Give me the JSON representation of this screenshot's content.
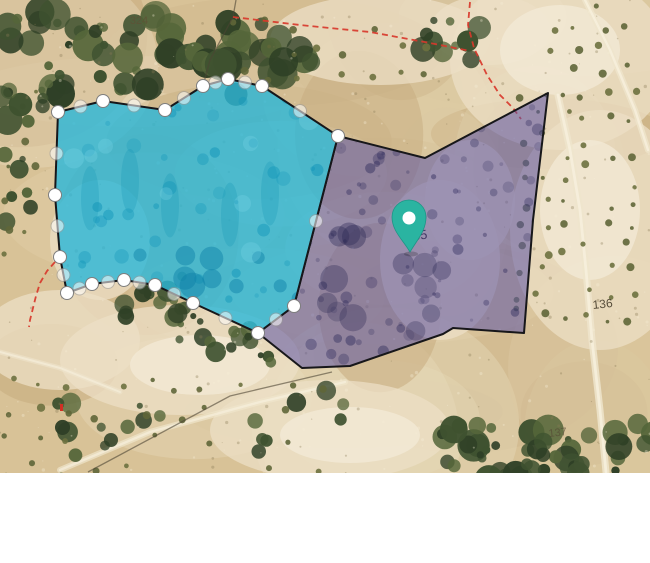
{
  "map": {
    "view": {
      "width": 650,
      "map_height": 473,
      "total_height": 563,
      "area_below_map_color": "#ffffff"
    },
    "terrain_palette": {
      "land_base": "#d8c297",
      "land_soft": [
        "#e3d4b0",
        "#cfb88e",
        "#e9ddbf",
        "#c8ad80",
        "#dcc9a2"
      ],
      "field_pale": "#ecdfc6",
      "field_paler": "#f3ebd9",
      "scrub_dark": "#3f5230",
      "scrub_mid": "#55663a",
      "scrub_deep": "#2f4026",
      "olive_dot_a": "#5f6638",
      "olive_dot_b": "#6d713f",
      "path_light": "#efe5cc",
      "path_bright": "#f7f0dd",
      "track_dark": "#4c4434",
      "speckle_dark": "#8a7a55",
      "speckle_light": "#f5edd8"
    },
    "parcel_labels": [
      {
        "text": "324",
        "x": 139,
        "y": 24,
        "color": "#5f5136",
        "size": 11,
        "opacity": 0.8,
        "rotation": 0
      },
      {
        "text": "135",
        "x": 417,
        "y": 240,
        "color": "#3e3560",
        "size": 13,
        "opacity": 0.95,
        "rotation": -8
      },
      {
        "text": "136",
        "x": 603,
        "y": 308,
        "color": "#463d2c",
        "size": 12,
        "opacity": 0.9,
        "rotation": -6
      },
      {
        "text": "137",
        "x": 558,
        "y": 436,
        "color": "#564b36",
        "size": 11,
        "opacity": 0.7,
        "rotation": -6
      }
    ],
    "red_boundaries": {
      "color": "#d8382b",
      "stroke_width": 1.8,
      "dash": "6 4",
      "lines": [
        {
          "id": "north-boundary",
          "points": "233,17 300,25 370,32 430,43 470,51"
        },
        {
          "id": "northeast-boundary",
          "points": "470,2 468,25 474,48 487,75 500,95 513,108 521,119"
        },
        {
          "id": "southwest-boundary",
          "points": "55,262 47,271 40,283 36,296 33,308 30,320 29,327"
        }
      ]
    },
    "cadastral_dark_lines": [
      {
        "id": "north-junction",
        "points": "236,0 233,17 210,60 203,86"
      },
      {
        "id": "southwest-track",
        "points": "88,472 230,396 332,372"
      }
    ],
    "parcels": {
      "editing_parcel": {
        "description": "cyan parcel in vertex-edit mode",
        "fill": "#29b7d8",
        "fill_opacity": 0.8,
        "stroke": "#17171a",
        "stroke_width": 2,
        "vertices": [
          [
            58,
            112
          ],
          [
            103,
            101
          ],
          [
            165,
            110
          ],
          [
            203,
            86
          ],
          [
            228,
            79
          ],
          [
            262,
            86
          ],
          [
            338,
            136
          ],
          [
            294,
            306
          ],
          [
            258,
            333
          ],
          [
            193,
            303
          ],
          [
            155,
            285
          ],
          [
            124,
            280
          ],
          [
            92,
            284
          ],
          [
            67,
            293
          ],
          [
            60,
            257
          ],
          [
            55,
            195
          ]
        ],
        "vertex_handle": {
          "fill": "#ffffff",
          "stroke": "#7e7e7e",
          "radius": 6.5,
          "opacity": 1
        },
        "midpoint_handle": {
          "fill": "#ffffff",
          "stroke": "#9a9a9a",
          "radius": 6.5,
          "opacity": 0.55
        }
      },
      "selected_parcel": {
        "description": "purple selected parcel with location pin",
        "fill": "#5b54a4",
        "fill_opacity": 0.55,
        "stroke": "#17171a",
        "stroke_width": 2,
        "vertices": [
          [
            338,
            136
          ],
          [
            425,
            158
          ],
          [
            548,
            93
          ],
          [
            533,
            220
          ],
          [
            524,
            333
          ],
          [
            453,
            328
          ],
          [
            443,
            334
          ],
          [
            350,
            366
          ],
          [
            302,
            368
          ],
          [
            258,
            333
          ],
          [
            294,
            306
          ]
        ]
      }
    },
    "location_pin": {
      "tip_x": 410,
      "tip_y": 252,
      "color": "#2ab4a1",
      "hole_color": "#ffffff"
    },
    "small_red_symbol": {
      "x": 60,
      "y": 409,
      "color": "#d12f23"
    }
  }
}
